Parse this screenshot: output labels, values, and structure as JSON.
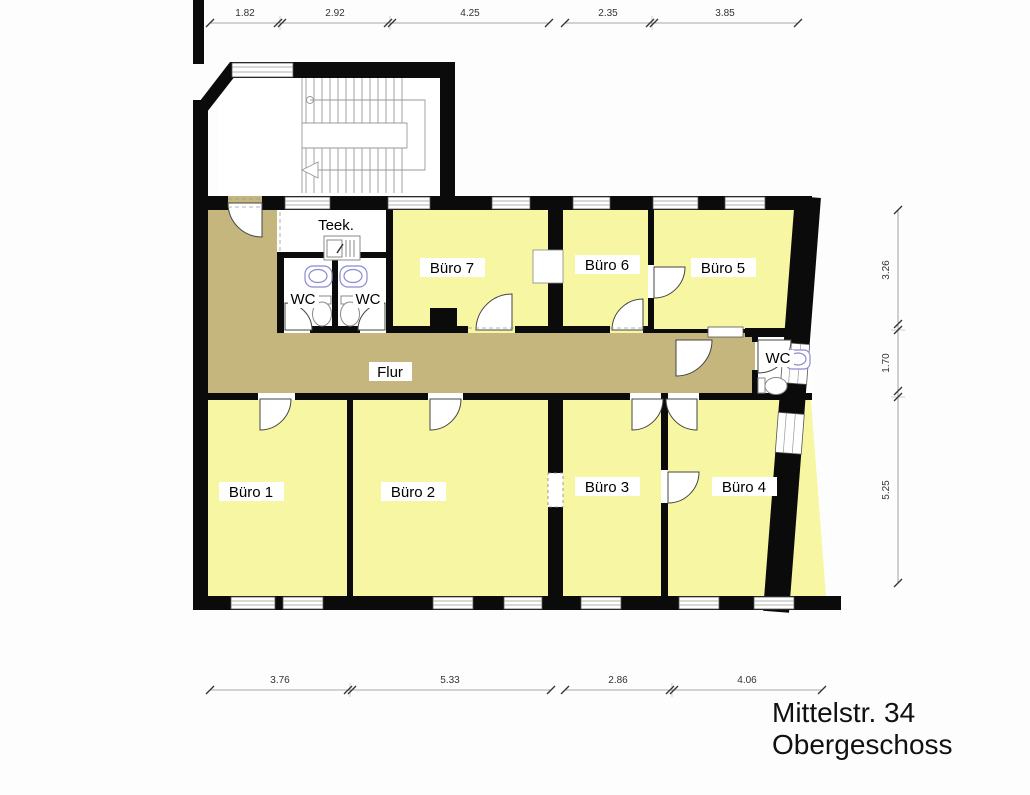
{
  "title": {
    "line1": "Mittelstr. 34",
    "line2": "Obergeschoss"
  },
  "rooms": {
    "buero1": "Büro 1",
    "buero2": "Büro 2",
    "buero3": "Büro 3",
    "buero4": "Büro 4",
    "buero5": "Büro 5",
    "buero6": "Büro 6",
    "buero7": "Büro 7",
    "flur": "Flur",
    "teek": "Teek.",
    "wc_small_left": "WC",
    "wc_small_right": "WC",
    "wc_corridor": "WC"
  },
  "dimensions": {
    "top": [
      "1.82",
      "2.92",
      "4.25",
      "2.35",
      "3.85"
    ],
    "bottom": [
      "3.76",
      "5.33",
      "2.86",
      "4.06"
    ],
    "right": [
      "3.26",
      "1.70",
      "5.25"
    ]
  },
  "colors": {
    "office": "#f7f7a3",
    "corridor": "#c4b67c",
    "wall": "#0b0b0b",
    "sanitary_fixture": "#8a8ad2"
  }
}
